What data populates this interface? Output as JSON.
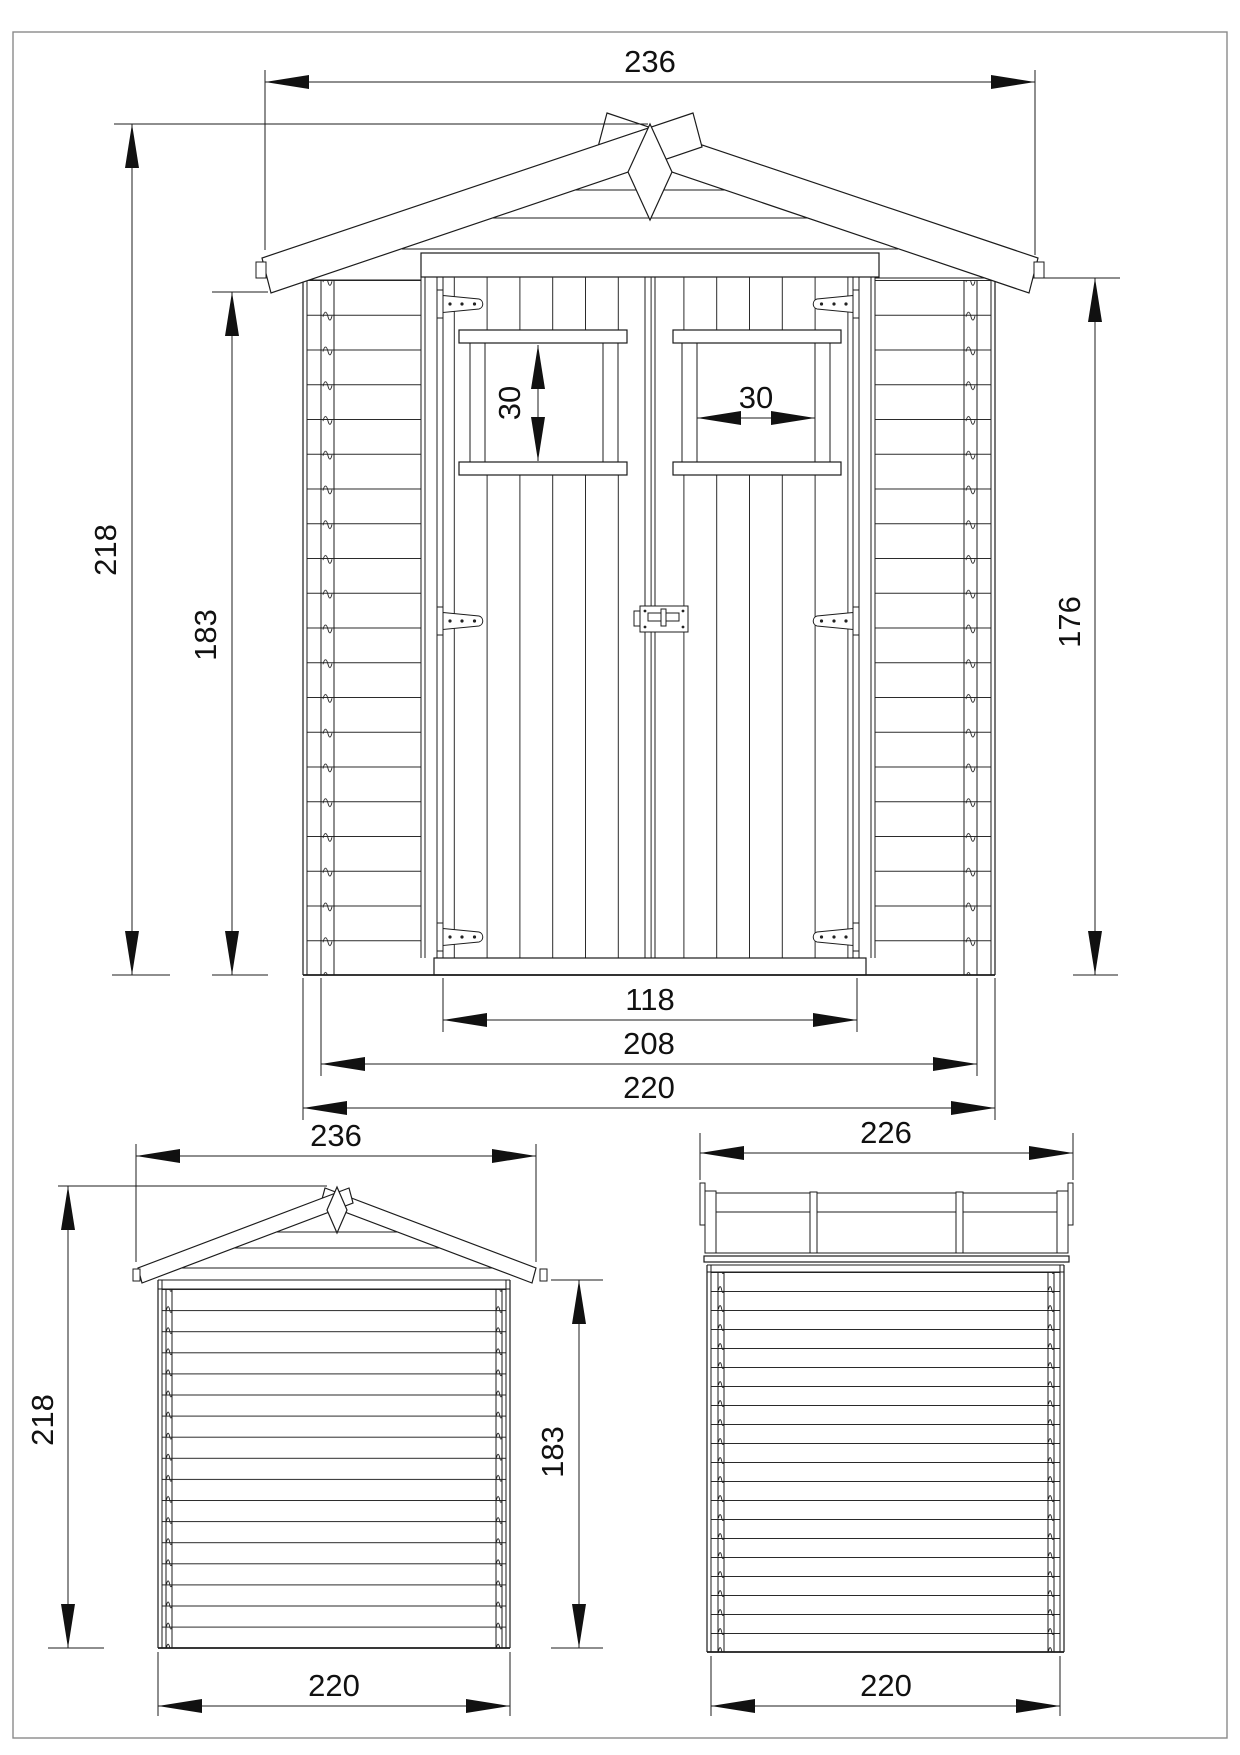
{
  "document": {
    "kind": "shed dimensional drawing",
    "line_color": "#1c1c1c",
    "background_color": "#ffffff",
    "border_color": "#8a8a8a"
  },
  "front": {
    "roof_width": "236",
    "total_height": "218",
    "wall_height": "183",
    "side_height": "176",
    "window_height": "30",
    "window_width": "30",
    "door_width": "118",
    "inner_width": "208",
    "base_width": "220"
  },
  "rear": {
    "roof_width": "236",
    "total_height": "218",
    "wall_height": "183",
    "base_width": "220"
  },
  "side": {
    "roof_depth": "226",
    "base_depth": "220"
  }
}
